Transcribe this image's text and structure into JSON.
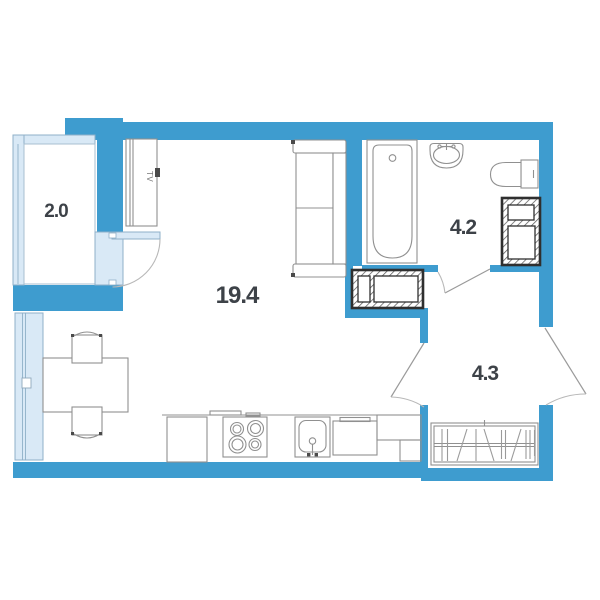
{
  "rooms": [
    {
      "id": "balcony",
      "area_label": "2.0"
    },
    {
      "id": "living-room",
      "area_label": "19.4"
    },
    {
      "id": "bathroom",
      "area_label": "4.2"
    },
    {
      "id": "hallway",
      "area_label": "4.3"
    }
  ],
  "tv_label": "TV",
  "fixtures": [
    "tv-cabinet",
    "sofa",
    "dining-table",
    "chair",
    "chair",
    "fridge",
    "stove",
    "kitchen-sink",
    "kitchen-cabinet",
    "bathtub",
    "washbasin",
    "toilet",
    "ventilation-shaft",
    "ventilation-shaft",
    "wardrobe",
    "balcony-door",
    "bathroom-door",
    "room-door",
    "entrance-door",
    "window",
    "balcony-glazing"
  ],
  "colors": {
    "wall": "#3e9ccf",
    "glazing": "#d9e9f6",
    "glazing_border": "#8fb0c8",
    "furniture_line": "#909090",
    "duct_border": "#2f2f2f",
    "text": "#3d4248",
    "background": "#ffffff"
  }
}
